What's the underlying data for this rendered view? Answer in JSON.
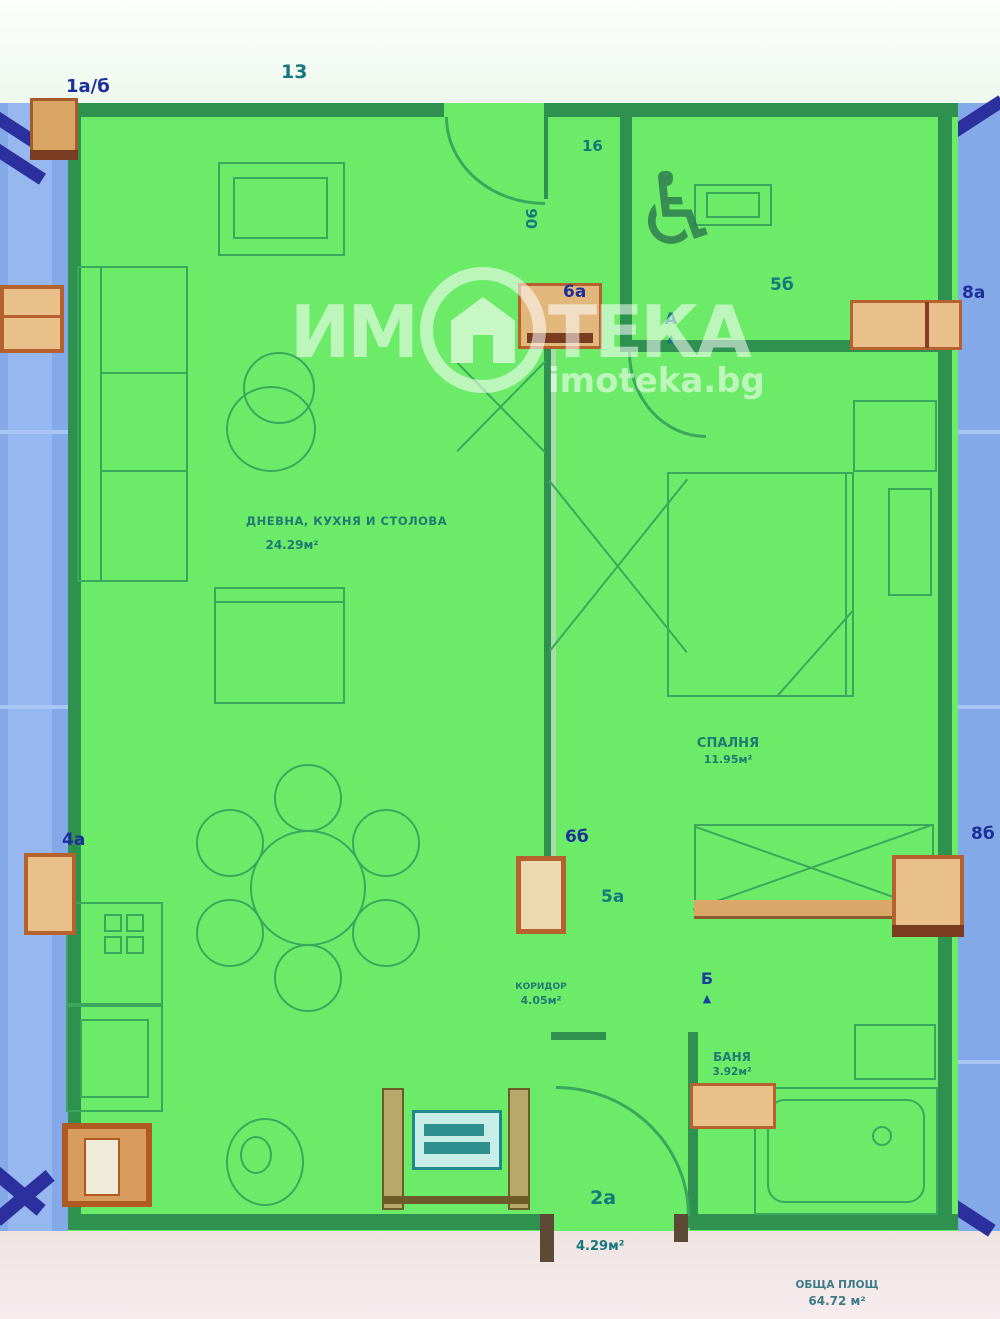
{
  "watermark": {
    "left": "ИМ",
    "right": "ТЕКА",
    "site": "imoteka.bg"
  },
  "axis": {
    "top_left": "1а/б",
    "entry": "6а",
    "right_upper": "8а",
    "left_lower": "4а",
    "center_lower": "6б",
    "right_lower": "8б"
  },
  "dims": {
    "top": "13",
    "entry_h": "16",
    "entry_v": "90",
    "window_upper": "5б",
    "window_lower": "5а",
    "door_a": "А",
    "door_b": "Б",
    "terrace_no": "2а"
  },
  "rooms": {
    "living": {
      "name": "ДНЕВНА, КУХНЯ И СТОЛОВА",
      "area": "24.29м²"
    },
    "bedroom": {
      "name": "СПАЛНЯ",
      "area": "11.95м²"
    },
    "bathroom": {
      "name": "БАНЯ",
      "area": "3.92м²"
    },
    "corridor": {
      "name": "КОРИДОР",
      "area": "4.05м²"
    },
    "terrace": {
      "area": "4.29м²"
    }
  },
  "summary": {
    "line1": "ОБЩА ПЛОЩ",
    "line2": "64.72 м²"
  },
  "glyphs": {
    "wheelchair": "♿",
    "arrow_up": "▲"
  },
  "colors": {
    "apartment_fill": "#6ceb68",
    "adjacent_fill": "#84a9e9",
    "marker_orange": "#b5622f",
    "label_navy": "#1c2f9a",
    "label_teal": "#15787c"
  }
}
